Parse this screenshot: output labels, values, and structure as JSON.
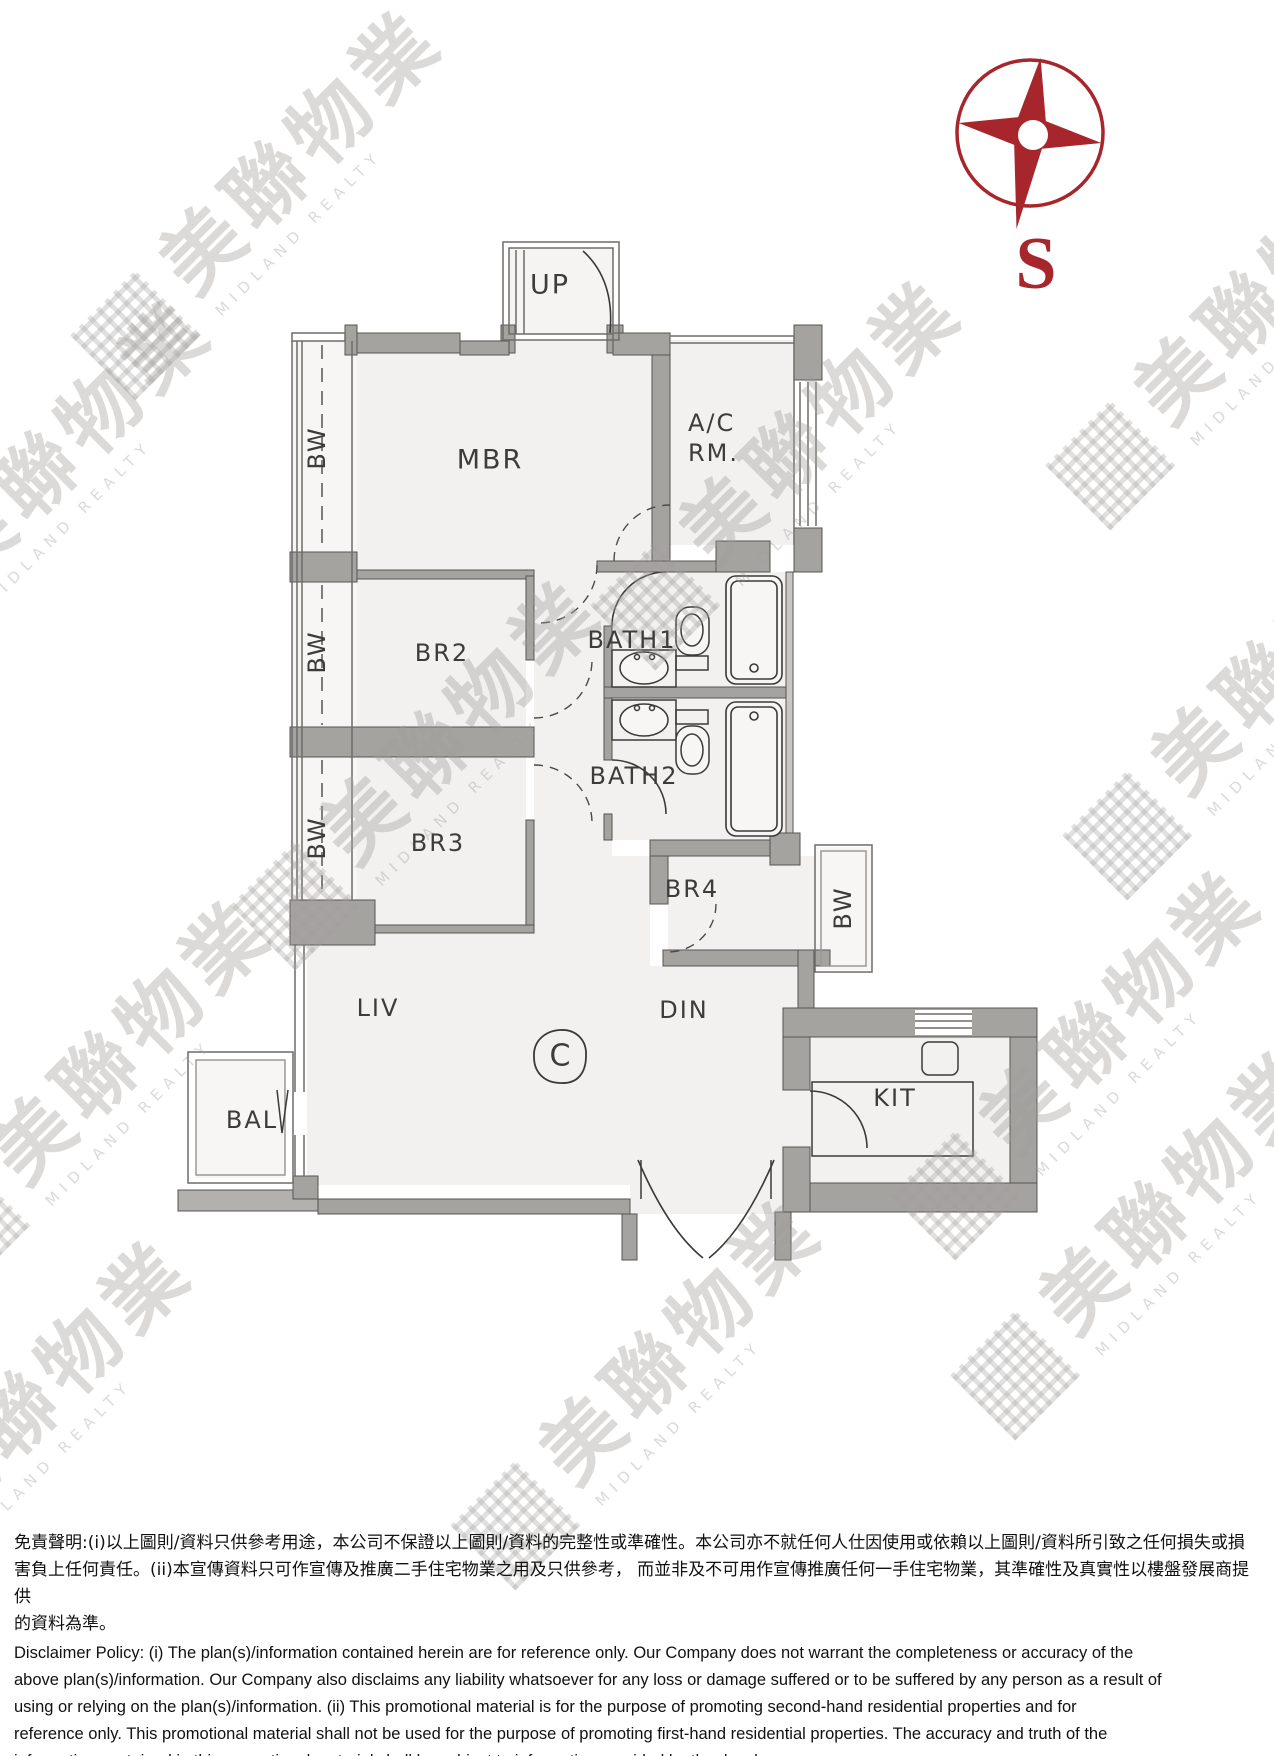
{
  "compass": {
    "south_label": "S"
  },
  "plan": {
    "labels": {
      "up": "UP",
      "mbr": "MBR",
      "ac_rm": "A/C\nRM.",
      "br2": "BR2",
      "br3": "BR3",
      "br4": "BR4",
      "bath1": "BATH1",
      "bath2": "BATH2",
      "bw": "BW",
      "liv": "LIV",
      "din": "DIN",
      "bal": "BAL",
      "kit": "KIT",
      "unit": "C"
    }
  },
  "watermark": {
    "zh": "美聯物業",
    "en": "MIDLAND REALTY"
  },
  "disclaimer": {
    "zh": "免責聲明:(i)以上圖則/資料只供參考用途，本公司不保證以上圖則/資料的完整性或準確性。本公司亦不就任何人仕因使用或依賴以上圖則/資料所引致之任何損失或損\n害負上任何責任。(ii)本宣傳資料只可作宣傳及推廣二手住宅物業之用及只供參考， 而並非及不可用作宣傳推廣任何一手住宅物業，其準確性及真實性以樓盤發展商提供\n的資料為準。",
    "en": "Disclaimer Policy: (i) The plan(s)/information contained herein are for reference only. Our Company does not warrant the completeness or accuracy of the\nabove plan(s)/information. Our Company also disclaims any liability whatsoever for any loss or damage suffered or to be suffered by any person as a result of\nusing or relying on the plan(s)/information. (ii) This promotional material is for the purpose of promoting second-hand residential properties and for\nreference only. This promotional material shall not be used for the purpose of promoting first-hand residential properties. The accuracy and truth of the\ninformation contained in this promotional material shall be subject to information provided by the developers."
  },
  "colors": {
    "compass_red": "#a7262c",
    "wall_gray": "#a5a3a0",
    "floor": "#f2f1ef",
    "watermark_gray": "#d9d8d6"
  }
}
